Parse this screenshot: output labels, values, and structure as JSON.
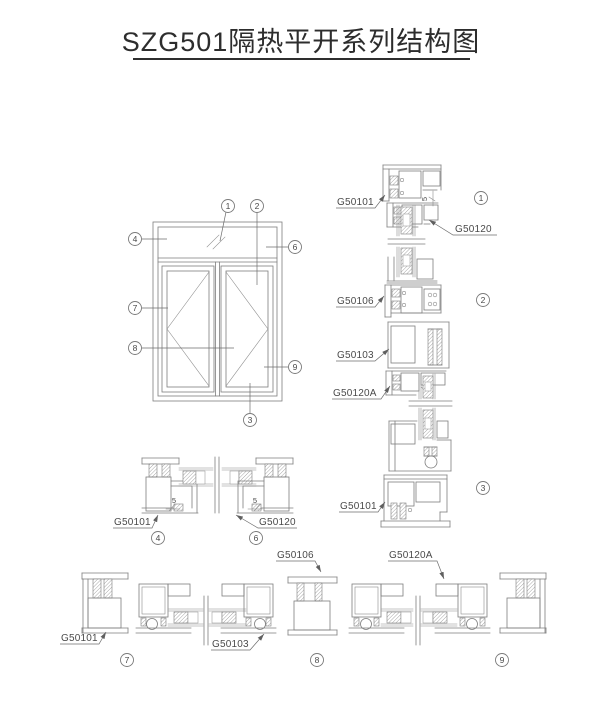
{
  "title": "SZG501隔热平开系列结构图",
  "colors": {
    "line": "#7e7e7e",
    "label_text": "#4a4a4a",
    "title_text": "#2d2d2d",
    "background": "#ffffff"
  },
  "callouts": {
    "c1": "1",
    "c2": "2",
    "c3": "3",
    "c4": "4",
    "c6": "6",
    "c7": "7",
    "c8": "8",
    "c9": "9"
  },
  "labels": {
    "right_top_frame": "G50101",
    "right_top_sash": "G50120",
    "right_transom": "G50106",
    "right_mullion": "G50103",
    "right_sash_a": "G50120A",
    "right_bottom_frame": "G50101",
    "mid_frame": "G50101",
    "mid_sash": "G50120",
    "bottom_mullion": "G50106",
    "bottom_sash_a": "G50120A",
    "bottom_frame": "G50101",
    "bottom_sash": "G50103"
  },
  "dims": {
    "d_top": "5",
    "d_left": "5",
    "d_right": "5"
  }
}
